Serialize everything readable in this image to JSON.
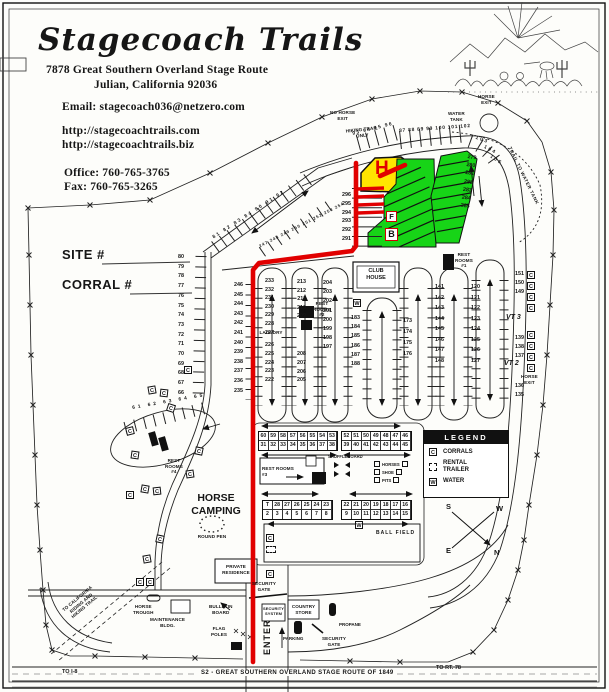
{
  "header": {
    "title": "Stagecoach Trails",
    "address_line1": "7878 Great Southern Overland Stage Route",
    "address_line2": "Julian, California   92036",
    "email": "Email:  stagecoach036@netzero.com",
    "url1": "http://stagecoachtrails.com",
    "url2": "http://stagecoachtrails.biz",
    "office": "Office: 760-765-3765",
    "fax": "Fax:  760-765-3265"
  },
  "form": {
    "site": "SITE #",
    "corral": "CORRAL #"
  },
  "legend": {
    "title": "LEGEND",
    "corrals": "CORRALS",
    "rental": "RENTAL\nTRAILER",
    "water": "WATER"
  },
  "compass": {
    "n": "N",
    "s": "S",
    "e": "E",
    "w": "W"
  },
  "symbols": {
    "corral": "C",
    "water": "W",
    "trailer": "T"
  },
  "zones": {
    "h": "H",
    "f": "F",
    "b": "B",
    "vt3": "VT 3",
    "vt2": "VT 2"
  },
  "labels": {
    "no_horse_exit": "NO HORSE\nEXIT",
    "hiking_trail_only": "HIKING TRAIL\nONLY",
    "horse_exit": "HORSE\nEXIT",
    "water_tank": "WATER\nTANK",
    "trail_to_water_tank": "TRAIL TO WATER TANK",
    "club_house": "CLUB\nHOUSE",
    "laundry": "LAUNDRY",
    "rest_rooms_1": "REST\nROOMS\n#1",
    "rest_rooms_2": "REST\nROOMS\n#2",
    "rest_rooms_3": "REST ROOMS\n#3",
    "rest_rooms_4": "REST\nROOMS\n#4",
    "shuffleboard": "SHUFFLEBOARD",
    "horseshoe": [
      "HORSES",
      "SHOE",
      "PITS"
    ],
    "ball_field": "BALL FIELD",
    "horse_camping": "HORSE\nCAMPING",
    "round_pen": "ROUND PEN",
    "private_residence": "PRIVATE\nRESIDENCE",
    "security_gate": "SECURITY\nGATE",
    "security_system": "SECURITY\nSYSTEM",
    "country_store": "COUNTRY\nSTORE",
    "parking": "PARKING",
    "propane": "PROPANE",
    "enter": "ENTER",
    "bulletin_board": "BULLETIN\nBOARD",
    "flag_poles": "FLAG\nPOLES",
    "maintenance": "MAINTENANCE\nBLDG.",
    "horse_trough": "HORSE\nTROUGH",
    "ca_trail": "TO CALIFORNIA\nRIDING AND\nHIKING TRAIL",
    "to_i8": "TO I-8",
    "to_rt78": "TO RT. 78",
    "highway": "S2 - GREAT SOUTHERN OVERLAND STAGE ROUTE OF 1849"
  },
  "sites": {
    "top_diagonal": [
      "93",
      "94",
      "95",
      "96"
    ],
    "top_row": [
      "87",
      "88",
      "89",
      "99",
      "100",
      "101",
      "102"
    ],
    "top_curve_103": "103",
    "top_curve_104": "104",
    "top_curve_105": "105",
    "striped_row": [
      "296",
      "295",
      "294",
      "293",
      "292",
      "291"
    ],
    "green_edge": [
      "279",
      "280",
      "281",
      "282",
      "283",
      "284",
      "285"
    ],
    "left_column": [
      "80",
      "79",
      "78",
      "77",
      "76",
      "75",
      "74",
      "73",
      "72",
      "71",
      "70",
      "69",
      "68",
      "67",
      "66"
    ],
    "upper_diagonal": [
      "81",
      "82",
      "83",
      "84",
      "90",
      "91",
      "92"
    ],
    "mid_diagonal": [
      "247",
      "248",
      "249",
      "250",
      "251",
      "252",
      "253",
      "254"
    ],
    "outer_left": [
      "246",
      "245",
      "244",
      "243",
      "242",
      "241",
      "240",
      "239",
      "238",
      "237",
      "236",
      "235"
    ],
    "loop1_a": [
      "233",
      "232",
      "231",
      "230",
      "229",
      "228",
      "227"
    ],
    "loop1_b": [
      "226",
      "225",
      "224",
      "223",
      "222"
    ],
    "loop2_a": [
      "213",
      "212",
      "211",
      "210",
      "209"
    ],
    "loop2_b": [
      "208",
      "207",
      "206",
      "205"
    ],
    "loop3": [
      "204",
      "203",
      "202",
      "201",
      "200",
      "199",
      "198",
      "197"
    ],
    "loop3_r": [
      "183",
      "184",
      "185",
      "186",
      "187",
      "188"
    ],
    "loop4_r": [
      "173",
      "174",
      "175",
      "176"
    ],
    "loop5": [
      "141",
      "142",
      "143",
      "144",
      "145",
      "146",
      "147",
      "148"
    ],
    "loop6": [
      "120",
      "121",
      "122",
      "123",
      "124",
      "125",
      "126",
      "127"
    ],
    "right_a": [
      "151",
      "150",
      "149"
    ],
    "right_b": [
      "139",
      "138",
      "137"
    ],
    "right_c": [
      "136",
      "135"
    ],
    "horse_camp_row": "61  62  63  64  65"
  },
  "grids": {
    "t1r1": [
      "60",
      "59",
      "58",
      "57",
      "56",
      "55",
      "54",
      "53"
    ],
    "t1r2": [
      "31",
      "32",
      "33",
      "34",
      "35",
      "36",
      "37",
      "38"
    ],
    "t2r1": [
      "52",
      "51",
      "50",
      "49",
      "48",
      "47",
      "46"
    ],
    "t2r2": [
      "39",
      "40",
      "41",
      "42",
      "43",
      "44",
      "45"
    ],
    "t3r1": [
      "T",
      "28",
      "27",
      "26",
      "25",
      "24",
      "23"
    ],
    "t3r2": [
      "2",
      "3",
      "4",
      "5",
      "6",
      "7",
      "8"
    ],
    "t4r1": [
      "22",
      "21",
      "20",
      "19",
      "18",
      "17",
      "16"
    ],
    "t4r2": [
      "9",
      "10",
      "11",
      "12",
      "13",
      "14",
      "15"
    ]
  },
  "colors": {
    "route": "#e10000",
    "highlight_yellow": "#ffe500",
    "highlight_green": "#17d417"
  }
}
